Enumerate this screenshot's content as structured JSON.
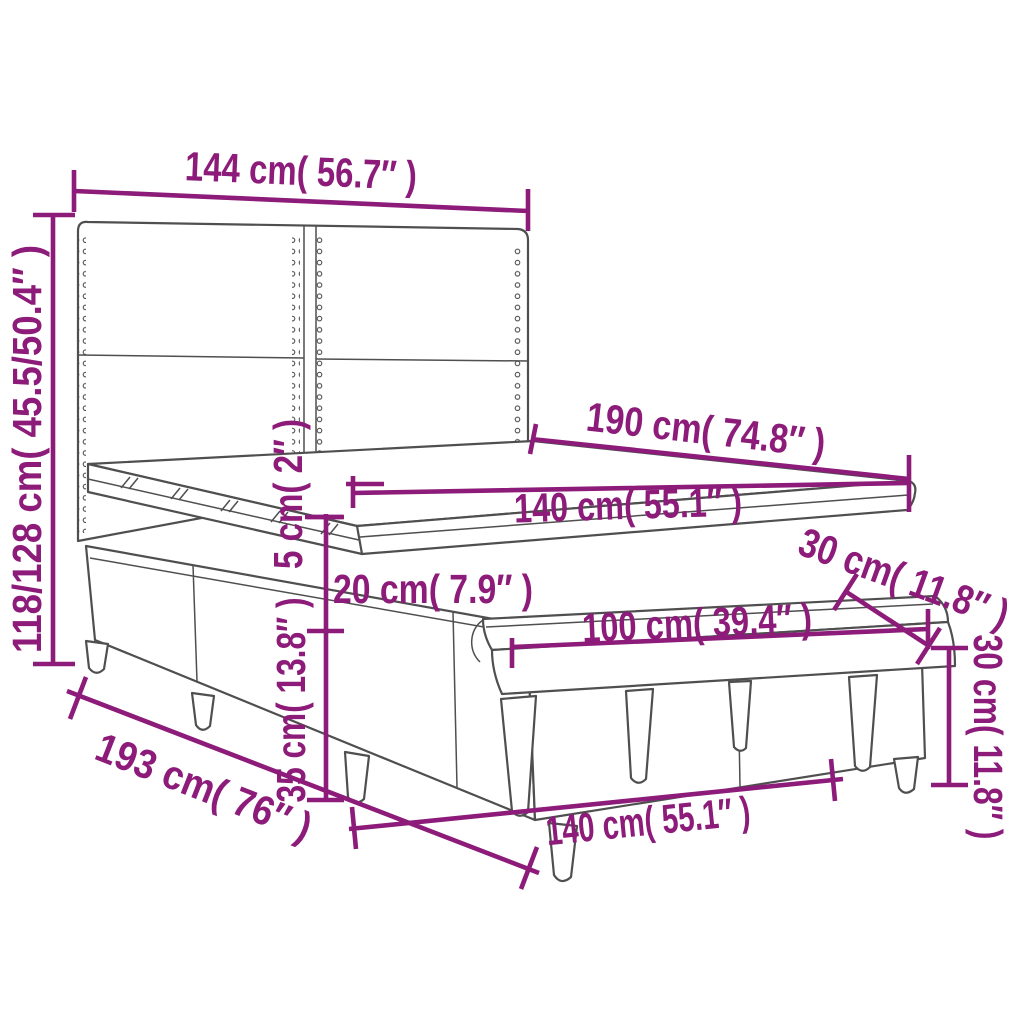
{
  "diagram": {
    "title": "Box spring bed with headboard, mattress topper and bench — dimension diagram",
    "type": "product-dimension-diagram",
    "colors": {
      "dimension_color": "#8C1B79",
      "outline_color": "#4F4F4F",
      "background": "#FFFFFF"
    },
    "labels": {
      "headboard_width": "144 cm( 56.7″ )",
      "total_height": "118/128 cm( 45.5/50.4″ )",
      "bed_length": "190 cm( 74.8″ )",
      "bed_width": "140 cm( 55.1″ )",
      "topper_height": "5 cm( 2″ )",
      "mattress_height": "20 cm( 7.9″ )",
      "base_height": "35 cm( 13.8″ )",
      "footprint_length": "193 cm( 76″ )",
      "footprint_width": "140 cm( 55.1″ )",
      "bench_length": "100 cm( 39.4″ )",
      "bench_depth": "30 cm( 11.8″ )",
      "bench_height": "30 cm( 11.8″ )"
    }
  }
}
